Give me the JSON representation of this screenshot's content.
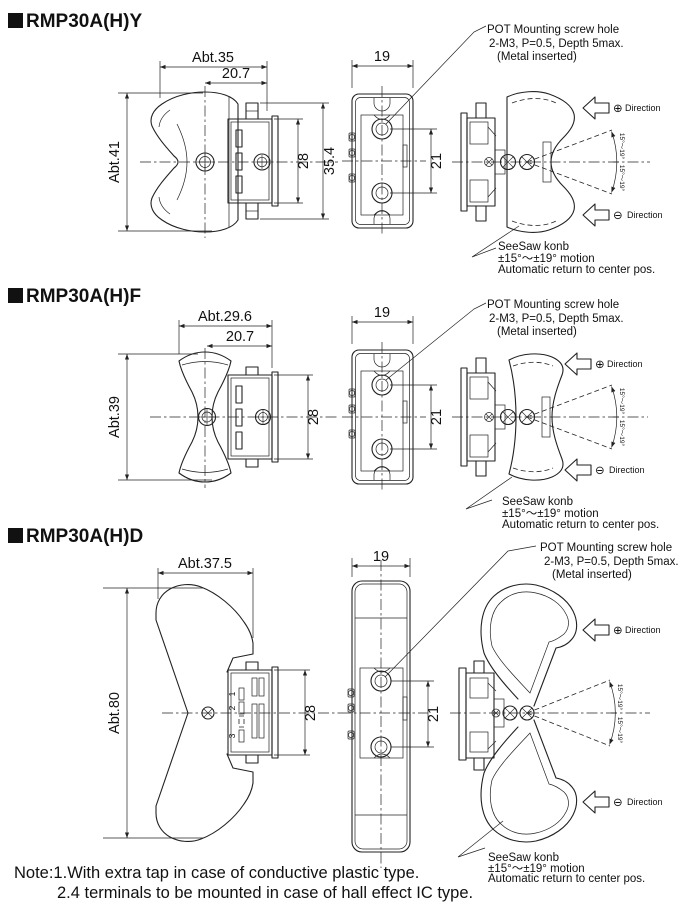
{
  "sections": [
    {
      "title": "RMP30A(H)Y",
      "dims": {
        "overall_width": "Abt.35",
        "knob_width": "20.7",
        "knob_height": "Abt.41",
        "body_height": "28",
        "overall_height": "35.4",
        "depth": "19",
        "hole_pitch": "21"
      }
    },
    {
      "title": "RMP30A(H)F",
      "dims": {
        "overall_width": "Abt.29.6",
        "knob_width": "20.7",
        "knob_height": "Abt.39",
        "body_height": "28",
        "depth": "19",
        "hole_pitch": "21"
      }
    },
    {
      "title": "RMP30A(H)D",
      "dims": {
        "overall_width": "Abt.37.5",
        "knob_height": "Abt.80",
        "body_height": "28",
        "depth": "19",
        "hole_pitch": "21"
      },
      "terminals": [
        "1",
        "2",
        "3"
      ]
    }
  ],
  "annotations": {
    "pot_hole": {
      "line1": "POT Mounting screw hole",
      "line2": "2-M3, P=0.5, Depth 5max.",
      "line3": "(Metal inserted)"
    },
    "seesaw": {
      "line1": "SeeSaw konb",
      "line2": "±15°〜±19° motion",
      "line3": "Automatic return to center pos."
    },
    "direction_plus": {
      "symbol": "⊕",
      "label": "Direction"
    },
    "direction_minus": {
      "symbol": "⊖",
      "label": "Direction"
    },
    "arc_range": "15°〜19°"
  },
  "note": {
    "line1": "Note:1.With extra tap in case of conductive plastic type.",
    "line2": "2.4 terminals to be mounted in case of hall effect IC type."
  },
  "colors": {
    "line": "#222222",
    "background": "#ffffff"
  }
}
